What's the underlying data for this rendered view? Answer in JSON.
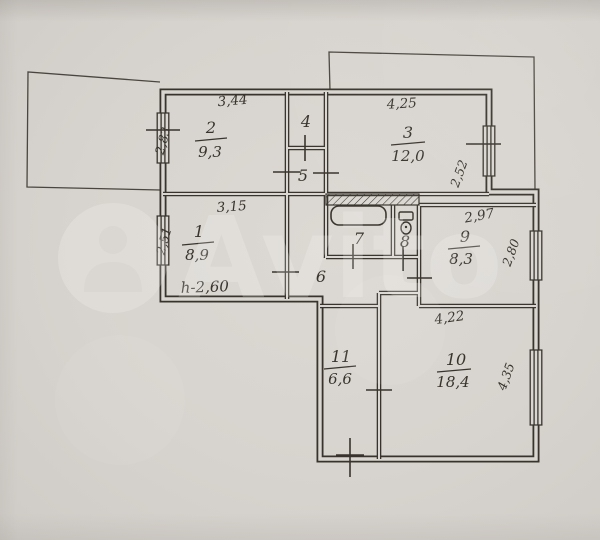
{
  "watermark": {
    "brand": "Avito"
  },
  "plan": {
    "note_height": "h-2,60",
    "rooms": {
      "r1": {
        "number": "1",
        "area": "8,9"
      },
      "r2": {
        "number": "2",
        "area": "9,3"
      },
      "r3": {
        "number": "3",
        "area": "12,0"
      },
      "r4": {
        "number": "4"
      },
      "r5": {
        "number": "5"
      },
      "r6": {
        "number": "6"
      },
      "r7": {
        "number": "7"
      },
      "r8": {
        "number": "8"
      },
      "r9": {
        "number": "9",
        "area": "8,3"
      },
      "r10": {
        "number": "10",
        "area": "18,4"
      },
      "r11": {
        "number": "11",
        "area": "6,6"
      }
    },
    "dimensions": {
      "r2_width": "3,44",
      "r2_window": "2,83",
      "r3_width": "4,25",
      "r3_window": "2,52",
      "r1_width": "3,15",
      "r1_window": "2,51",
      "r9_width": "2,97",
      "r9_window": "2,80",
      "r10_width": "4,22",
      "r10_window": "4,35"
    },
    "colors": {
      "paper": "#d7d3ce",
      "ink": "#38342d"
    }
  }
}
